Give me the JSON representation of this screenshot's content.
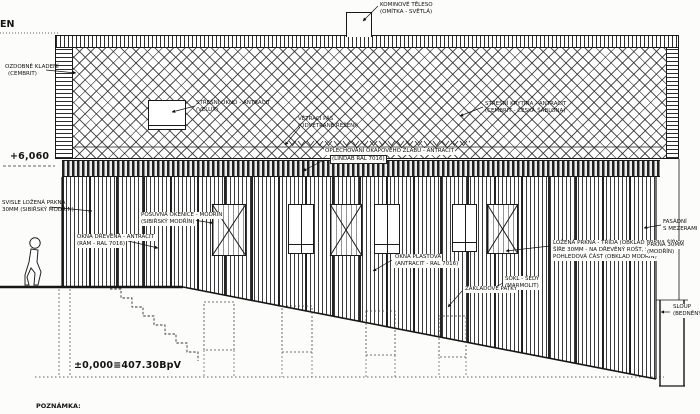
{
  "drawing": {
    "title_fragment": "EN",
    "note_label": "POZNÁMKA:",
    "levels": {
      "eaves": "+6,060",
      "ground": "±0,000≡407.30BpV"
    }
  },
  "colors": {
    "ink": "#181818",
    "paper": "#fcfcfa",
    "hatch": "#2c2c2c"
  },
  "callouts": {
    "chimney": {
      "l1": "KOMINOVÉ TĚLESO",
      "l2": "(OMÍTKA - SVĚTLÁ)"
    },
    "decor_cladding": {
      "l1": "OZDOBNÉ KLADENÍ",
      "l2": "(CEMBRIT)"
    },
    "skylight": {
      "l1": "STŘEŠNÍ OKNO - ANTRACIT",
      "l2": "(VELUX)"
    },
    "vent_strip": {
      "l1": "VĚTRACÍ PÁS",
      "l2": "(ODVĚTRANÉ ŘEŠENÍ)"
    },
    "gutter": {
      "l1": "OPLECHOVÁNÍ OKAPOVÉHO ŽLABU - ANTRACIT",
      "l2": "(LINDAB RAL 7016)"
    },
    "roofing": {
      "l1": "STŘEŠNÍ KRYTINA - ANTRACIT",
      "l2": "(CEMBRIT - ČESKÁ ŠABLONA)"
    },
    "boards": {
      "l1": "SVISLE LOŽENÁ PRKNA",
      "l2": "30MM (SIBIŘSKÝ MODŘÍN)"
    },
    "windows_left": {
      "l1": "OKNA DŘEVĚNÁ - ANTRACIT",
      "l2": "(RÁM - RAL 7016)"
    },
    "shutter": {
      "l1": "POSUVNÁ OKENICE - MODŘÍN",
      "l2": "(SIBIŘSKÝ MODŘÍN)"
    },
    "windows_center": {
      "l1": "OKNA PLASTOVÁ",
      "l2": "(ANTRACIT - RAL 7016)"
    },
    "cladding_right": {
      "l1": "LOŽENÁ PRKNA - TŘÍDA (OBKLAD PRKNA ŠÍŘKY)",
      "l2": "ŠÍŘE 30MM - NA DŘEVĚNÝ ROŠT, SPÁRA",
      "l3": "POHLEDOVÁ ČÁST (OBKLAD MODŘÍN)"
    },
    "plinth": {
      "l1": "SOKL - ŠEDÝ",
      "l2": "(MARMOLIT)"
    },
    "facade_gap": {
      "l1": "FASÁDNÍ",
      "l2": "S MEZERAMI"
    },
    "boards_right": {
      "l1": "PRKNA 30MM",
      "l2": "(MODŘÍN)"
    },
    "footings": {
      "l1": "ZÁKLADOVÉ PATKY"
    },
    "column": {
      "l1": "SLOUP",
      "l2": "(BEDNĚNÝ)"
    }
  }
}
